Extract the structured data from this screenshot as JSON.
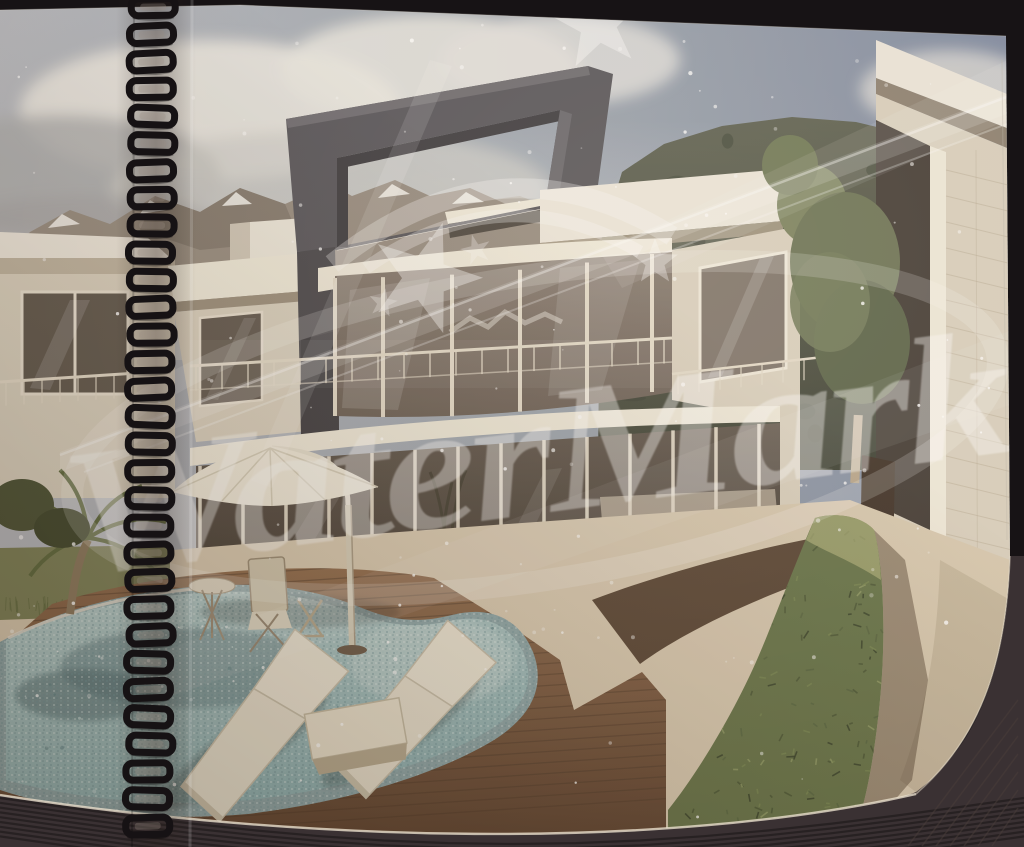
{
  "meta": {
    "media": "photograph of a spiral-bound presentation booklet page lying on a dark surface",
    "artwork": "3D architectural exterior rendering of a modern flat-roof villa with swimming pool in a mountain valley"
  },
  "watermark": {
    "text": "WaterMark",
    "color": "#ffffff",
    "opacity": "0.40",
    "angle_deg": -7.5,
    "decorations": [
      "five-point stars",
      "double arc swoosh",
      "orbit ellipse",
      "diagonal light streaks"
    ]
  },
  "binding": {
    "type": "black wire spiral binding",
    "side": "left",
    "loop_count": 31
  },
  "scene": {
    "setting": "partly cloudy sky, rocky snow-capped mountains left, dark forested ridge right",
    "elements": [
      "modern two-storey villa with dark rectangular portal roof frame",
      "curved glass curtain wall on upper floor with balcony railing",
      "full-height ground floor glazing with lounge furniture inside",
      "neighbouring white villa on the left edge",
      "neighbouring white villa on the right with stone wall",
      "ornamental tree between the buildings",
      "kidney-shaped mosaic-tiled swimming pool",
      "timber pool deck",
      "two cream sun loungers with side table",
      "cantilever parasol",
      "folding bistro chairs and small table",
      "clipped hedge row along stone walkway",
      "palm tree and dark shrubs at left",
      "grass strip beside the pool"
    ]
  },
  "photo_artifacts": [
    "white dust speckles over the print",
    "diagonal glare streaks",
    "page gutter shadow along the binding",
    "stacked page edges visible at bottom as dark ribbed band"
  ],
  "palette": {
    "bg": "#171315",
    "band": "#3a3133",
    "rib": "#241e20",
    "pageEdge": "#e7ddcb",
    "skyL": "#b7bac0",
    "skyM": "#9aa3ae",
    "skyR": "#7e8aa2",
    "cloud": "#e8e6e1",
    "cloudGray": "#abacae",
    "mtn": "#968c81",
    "mtnShade": "#7b7268",
    "snow": "#eceae5",
    "mtnR1": "#5c6051",
    "mtnR2": "#3b4034",
    "wallLight": "#ece7dc",
    "wallMid": "#d9d1c0",
    "wallShade": "#b4a894",
    "cream": "#efeadb",
    "frame1": "#55545a",
    "frame2": "#3b3a3f",
    "frame3": "#6c6a70",
    "glass1": "#857a70",
    "glass2": "#695e55",
    "glassDark": "#4a4239",
    "mullion": "#e4dccb",
    "deck1": "#8f6b4d",
    "deck2": "#5d4331",
    "plank": "#4e392a",
    "water1": "#b6cdcc",
    "water2": "#8fb2b4",
    "waterDark": "#5e7c81",
    "mosaic": "#8da6a9",
    "path1": "#d8cab2",
    "soil": "#4e3b2b",
    "grass": "#7c8159",
    "hedge1": "#a2a873",
    "hedge2": "#66744a",
    "hedge3": "#3c4830",
    "wire": "#161214",
    "wm": "#ffffff"
  }
}
